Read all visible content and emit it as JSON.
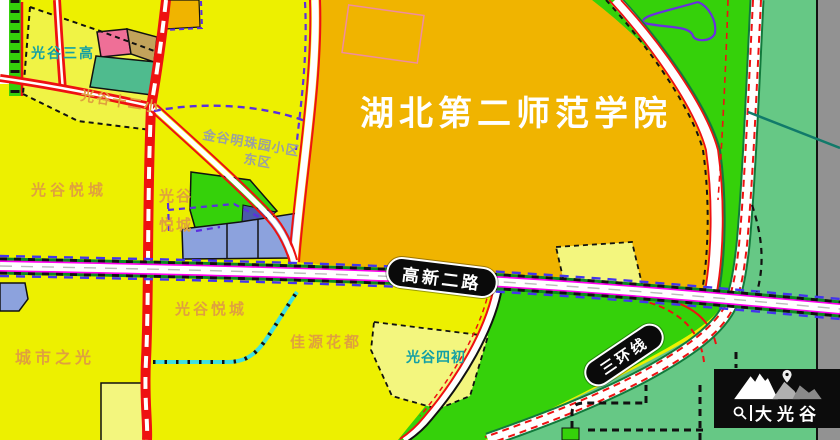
{
  "map": {
    "labels": {
      "school_title": "湖北第二师范学院",
      "sangao": "光谷三高",
      "shierxiao": "光谷十二小",
      "jingu_line1": "金谷明珠园小区",
      "jingu_line2": "东区",
      "yuecheng_west": "光谷悦城",
      "yuecheng_mid_line1": "光谷",
      "yuecheng_mid_line2": "悦城",
      "yuecheng_south": "光谷悦城",
      "chengshi": "城市之光",
      "jiayuan": "佳源花都",
      "sichu": "光谷四初"
    },
    "roads": {
      "gaoxin": "高新二路",
      "sanhuan": "三环线"
    },
    "logo": {
      "text": "大光谷"
    },
    "palette": {
      "background_yellow": "#edf000",
      "pale_parcel_yellow": "#f3f67e",
      "school_orange": "#f0b400",
      "bright_green": "#35d10a",
      "sea_green": "#66c885",
      "gray_strip": "#929292",
      "periwinkle_parcel": "#8ca2dd",
      "pink_parcel": "#ef6f97",
      "tan_parcel": "#c2a35b",
      "teal_parcel": "#4fbb8e",
      "navy_parcel": "#4a5aa8",
      "road_red": "#ee1111",
      "road_magenta": "#ff00f0",
      "dash_purple": "#5b2ee0",
      "dash_cyan": "#3fe0e0",
      "label_orange": "#dfa13e",
      "label_teal": "#14a0a4",
      "label_gray": "#9aa0a2"
    }
  }
}
